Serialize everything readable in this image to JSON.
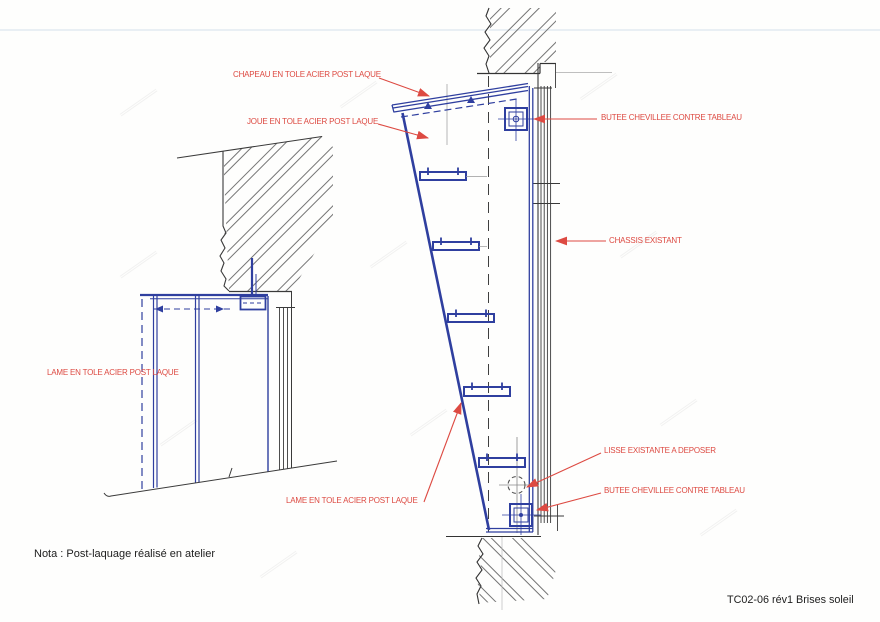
{
  "drawing": {
    "annotations": {
      "chapeau": "CHAPEAU EN TOLE ACIER POST LAQUE",
      "joue": "JOUE EN TOLE ACIER POST LAQUE",
      "butee_top": "BUTEE CHEVILLEE CONTRE TABLEAU",
      "chassis": "CHASSIS EXISTANT",
      "lisse": "LISSE EXISTANTE A DEPOSER",
      "butee_bottom": "BUTEE CHEVILLEE CONTRE TABLEAU",
      "lame_left": "LAME EN TOLE ACIER POST LAQUE",
      "lame_bottom": "LAME EN TOLE ACIER POST LAQUE"
    },
    "note": "Nota : Post-laquage réalisé en atelier",
    "title": "TC02-06 rév1 Brises soleil",
    "colors": {
      "new_steel_blue": "#2f3f9f",
      "existing_dark": "#3a3a3a",
      "annotation_red": "#dd4a42"
    }
  }
}
